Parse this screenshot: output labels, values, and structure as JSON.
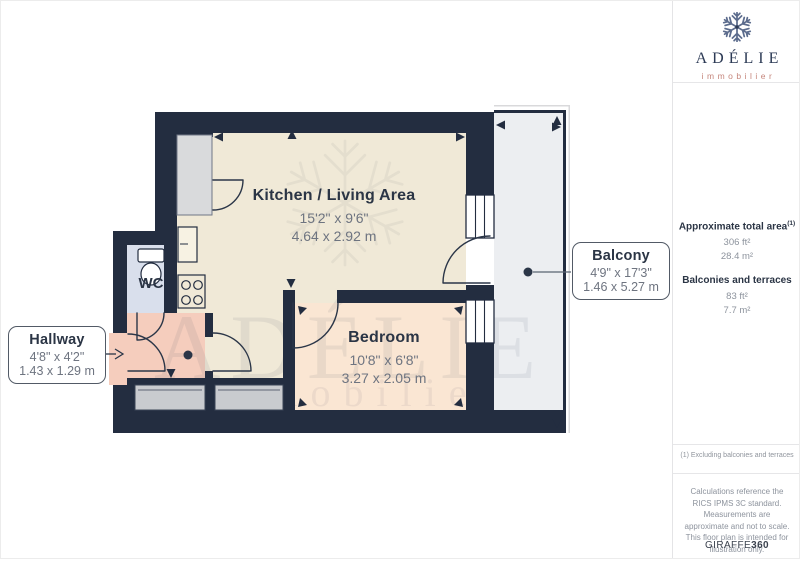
{
  "brand": {
    "name": "ADÉLIE",
    "tagline": "immobilier"
  },
  "floorplan": {
    "watermark": {
      "line1": "ADÉLIE",
      "line2": "immobilier"
    },
    "rooms": [
      {
        "name": "Kitchen / Living Area",
        "dims_imperial": "15'2\" x 9'6\"",
        "dims_metric": "4.64 x 2.92 m"
      },
      {
        "name": "Bedroom",
        "dims_imperial": "10'8\" x 6'8\"",
        "dims_metric": "3.27 x 2.05 m"
      },
      {
        "name": "Hallway",
        "dims_imperial": "4'8\" x 4'2\"",
        "dims_metric": "1.43 x 1.29 m"
      },
      {
        "name": "Balcony",
        "dims_imperial": "4'9\" x 17'3\"",
        "dims_metric": "1.46 x 5.27 m"
      },
      {
        "name": "WC"
      }
    ]
  },
  "sidebar": {
    "total_area": {
      "label": "Approximate total area",
      "marker": "(1)",
      "imperial": "306 ft²",
      "metric": "28.4 m²"
    },
    "balconies": {
      "label": "Balconies and terraces",
      "imperial": "83 ft²",
      "metric": "7.7 m²"
    },
    "footnote": "(1) Excluding balconies and terraces",
    "disclaimer": "Calculations reference the RICS IPMS 3C standard. Measurements are approximate and not to scale. This floor plan is intended for illustration only.",
    "credit": {
      "brand": "GIRAFFE",
      "suffix": "360"
    }
  },
  "colors": {
    "wall": "#232d40",
    "kitchen_floor": "#f0e9d7",
    "bedroom_floor": "#fae6d3",
    "hallway_floor": "#f5cdbd",
    "wc_floor": "#d9dfec",
    "balcony_floor": "#eceef1",
    "logo_navy": "#2c3a55",
    "logo_accent": "#c5857b"
  }
}
